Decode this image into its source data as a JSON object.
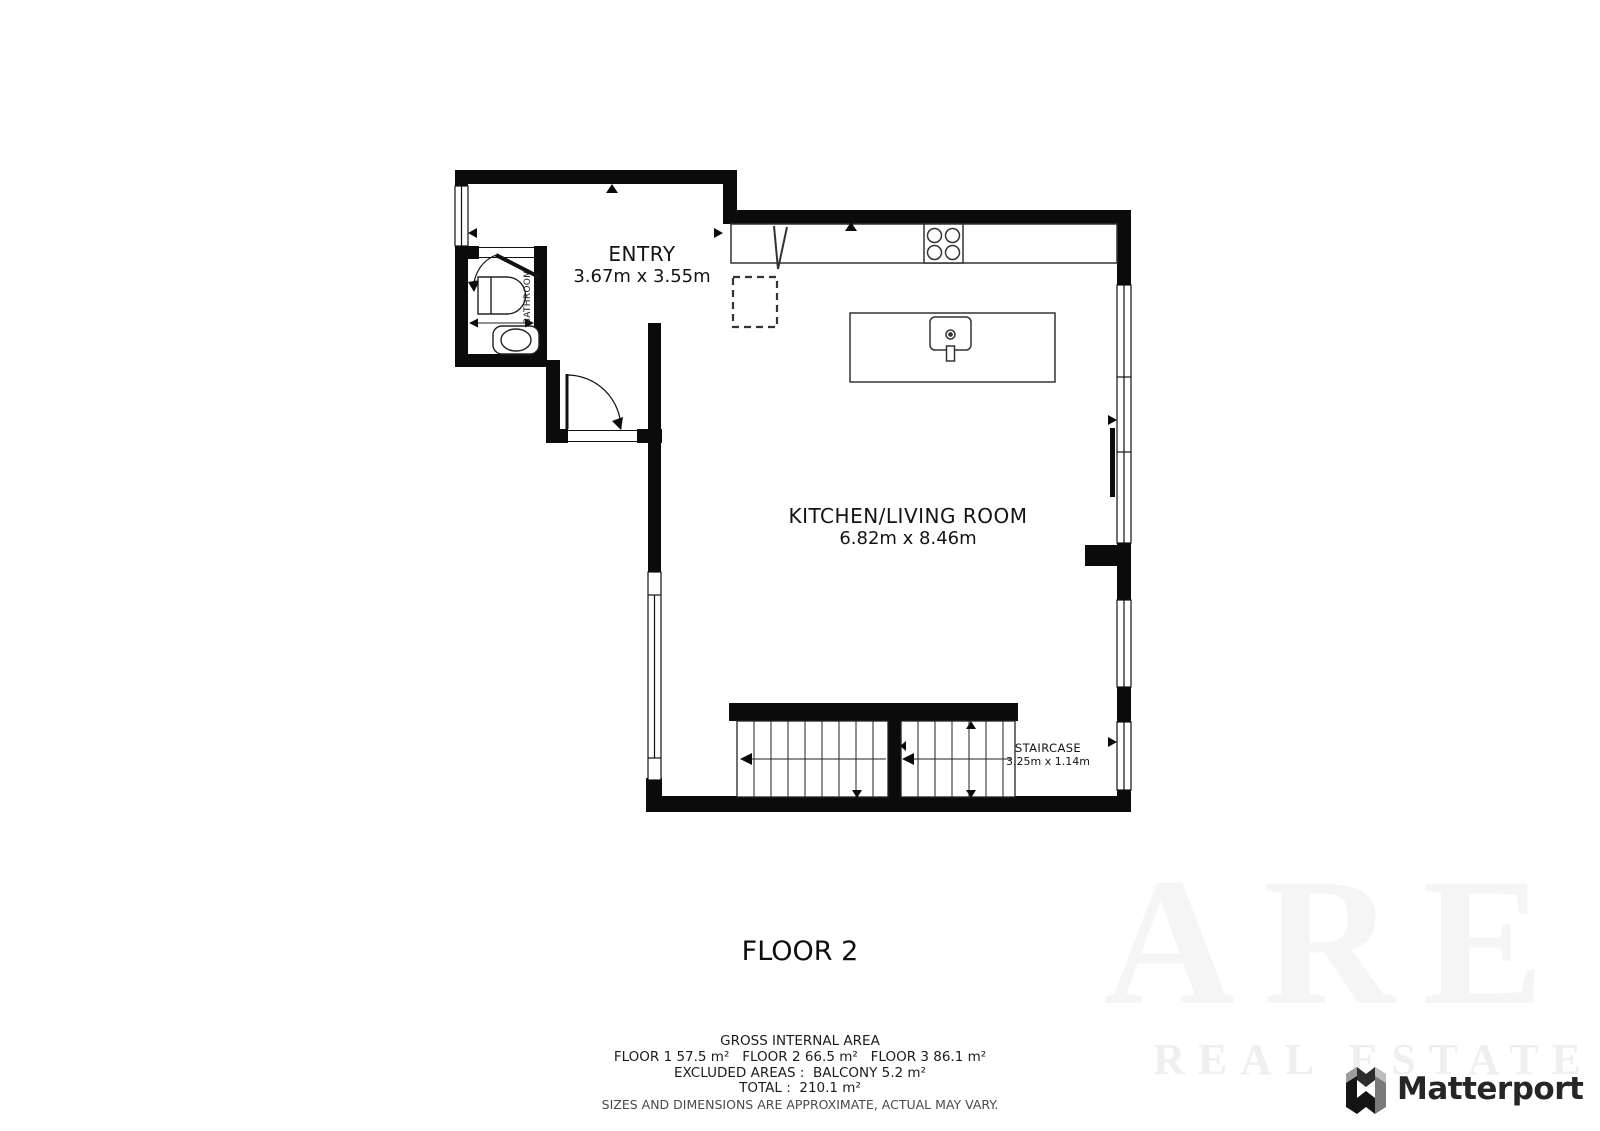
{
  "plan": {
    "floor_title": "FLOOR 2",
    "rooms": [
      {
        "id": "entry",
        "name": "ENTRY",
        "dims": "3.67m x 3.55m"
      },
      {
        "id": "kitchen_living",
        "name": "KITCHEN/LIVING ROOM",
        "dims": "6.82m x 8.46m"
      },
      {
        "id": "bathroom",
        "name": "BATHROOM",
        "dims": "1.10m x 1.51m"
      },
      {
        "id": "staircase",
        "name": "STAIRCASE",
        "dims": "3.25m x 1.14m"
      }
    ]
  },
  "footer": {
    "gross_internal_area_label": "GROSS INTERNAL AREA",
    "floor_areas": "FLOOR 1 57.5 m²   FLOOR 2 66.5 m²   FLOOR 3 86.1 m²",
    "excluded_areas": "EXCLUDED AREAS :  BALCONY 5.2 m²",
    "total": "TOTAL :  210.1 m²",
    "disclaimer": "SIZES AND DIMENSIONS ARE APPROXIMATE, ACTUAL MAY VARY."
  },
  "branding": {
    "logo_text": "Matterport",
    "logo_icon": "matterport-m-icon"
  },
  "watermark": {
    "line1": "ARE",
    "line2": "REAL ESTATE"
  },
  "colors": {
    "wall": "#0b0b0b",
    "background": "#ffffff",
    "fixture_stroke": "#333333",
    "disclaimer_text": "#4a4a4a",
    "watermark": "#f5f5f5"
  }
}
